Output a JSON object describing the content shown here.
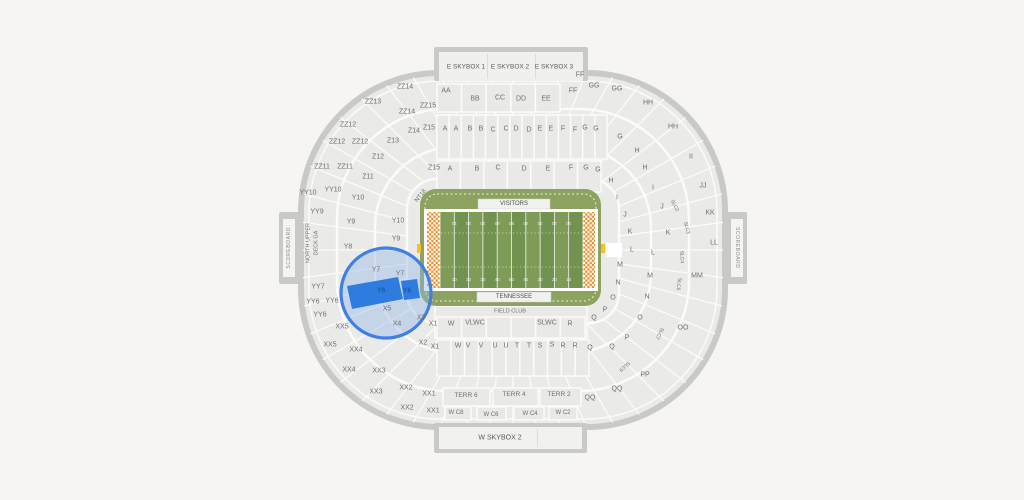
{
  "page": {
    "background": "#f6f5f3"
  },
  "stadium": {
    "scoreboard_left": "SCOREBOARD",
    "scoreboard_right": "SCOREBOARD",
    "skybox_top": [
      "E SKYBOX 1",
      "E SKYBOX 2",
      "E SKYBOX 3"
    ],
    "skybox_bottom": "W SKYBOX 2",
    "field": {
      "visitors_label": "VISITORS",
      "home_label": "TENNESSEE",
      "field_club_label": "FIELD CLUB",
      "corner_label": "NT18",
      "yards": [
        "10",
        "20",
        "30",
        "40",
        "50",
        "40",
        "30",
        "20",
        "10"
      ]
    },
    "selection": {
      "sections": [
        "Y6",
        "Y6"
      ]
    },
    "colors": {
      "selection_fill": "#2e7ce0",
      "selection_ring": "#3f80e2",
      "selection_tint": "#93b5e6",
      "selection_label": "#1c59ad",
      "field_stripe_light": "#7e9c58",
      "field_stripe_dark": "#72924f",
      "field_apron": "#8da25e",
      "endzone_orange": "#ef8a23",
      "bowl_fill": "#eaeae9",
      "ring_stroke": "#c9c9c8"
    },
    "labels": [
      {
        "t": "ZZ14",
        "x": 405,
        "y": 87
      },
      {
        "t": "ZZ13",
        "x": 373,
        "y": 102
      },
      {
        "t": "ZZ14",
        "x": 407,
        "y": 112
      },
      {
        "t": "ZZ15",
        "x": 428,
        "y": 106
      },
      {
        "t": "ZZ12",
        "x": 348,
        "y": 125
      },
      {
        "t": "ZZ12",
        "x": 337,
        "y": 142
      },
      {
        "t": "ZZ12",
        "x": 360,
        "y": 142
      },
      {
        "t": "ZZ11",
        "x": 322,
        "y": 167
      },
      {
        "t": "ZZ11",
        "x": 345,
        "y": 167
      },
      {
        "t": "YY10",
        "x": 308,
        "y": 193
      },
      {
        "t": "YY10",
        "x": 333,
        "y": 190
      },
      {
        "t": "YY9",
        "x": 317,
        "y": 212
      },
      {
        "t": "YY7",
        "x": 318,
        "y": 287
      },
      {
        "t": "YY6",
        "x": 313,
        "y": 302
      },
      {
        "t": "YY6",
        "x": 332,
        "y": 301
      },
      {
        "t": "YY6",
        "x": 320,
        "y": 315
      },
      {
        "t": "XX5",
        "x": 342,
        "y": 327
      },
      {
        "t": "XX5",
        "x": 330,
        "y": 345
      },
      {
        "t": "XX4",
        "x": 356,
        "y": 350
      },
      {
        "t": "XX4",
        "x": 349,
        "y": 370
      },
      {
        "t": "XX3",
        "x": 379,
        "y": 371
      },
      {
        "t": "XX3",
        "x": 376,
        "y": 392
      },
      {
        "t": "XX2",
        "x": 406,
        "y": 388
      },
      {
        "t": "XX2",
        "x": 407,
        "y": 408
      },
      {
        "t": "XX1",
        "x": 429,
        "y": 394
      },
      {
        "t": "XX1",
        "x": 433,
        "y": 411
      },
      {
        "t": "Z15",
        "x": 429,
        "y": 128
      },
      {
        "t": "Z14",
        "x": 414,
        "y": 131
      },
      {
        "t": "Z13",
        "x": 393,
        "y": 141
      },
      {
        "t": "Z12",
        "x": 378,
        "y": 157
      },
      {
        "t": "Z11",
        "x": 368,
        "y": 177
      },
      {
        "t": "Z15",
        "x": 434,
        "y": 168
      },
      {
        "t": "Y10",
        "x": 358,
        "y": 198
      },
      {
        "t": "Y10",
        "x": 398,
        "y": 221
      },
      {
        "t": "Y9",
        "x": 351,
        "y": 222
      },
      {
        "t": "Y9",
        "x": 396,
        "y": 239
      },
      {
        "t": "Y8",
        "x": 348,
        "y": 247
      },
      {
        "t": "Y7",
        "x": 376,
        "y": 270
      },
      {
        "t": "Y7",
        "x": 400,
        "y": 274
      },
      {
        "t": "Y6",
        "x": 381,
        "y": 291,
        "c": "#1c59ad",
        "w": 700,
        "n": "selected-section-label-y6"
      },
      {
        "t": "Y6",
        "x": 407,
        "y": 291,
        "c": "#1c59ad",
        "w": 700,
        "n": "selected-section-label-y6"
      },
      {
        "t": "X5",
        "x": 387,
        "y": 309
      },
      {
        "t": "X4",
        "x": 397,
        "y": 324
      },
      {
        "t": "X3",
        "x": 421,
        "y": 318
      },
      {
        "t": "X2",
        "x": 423,
        "y": 343
      },
      {
        "t": "X1",
        "x": 433,
        "y": 324
      },
      {
        "t": "X1",
        "x": 435,
        "y": 347
      },
      {
        "t": "NORTH UPPER",
        "x": 309,
        "y": 243,
        "r": -90,
        "s": 5.5,
        "n": "north-upper-deck-ga-label"
      },
      {
        "t": "DECK GA",
        "x": 317,
        "y": 243,
        "r": -90,
        "s": 5.5,
        "n": "north-upper-deck-ga-label"
      },
      {
        "t": "NT18",
        "x": 421,
        "y": 196,
        "r": -52,
        "s": 6
      },
      {
        "t": "AA",
        "x": 446,
        "y": 91
      },
      {
        "t": "BB",
        "x": 475,
        "y": 99
      },
      {
        "t": "CC",
        "x": 500,
        "y": 98
      },
      {
        "t": "DD",
        "x": 521,
        "y": 99
      },
      {
        "t": "EE",
        "x": 546,
        "y": 99
      },
      {
        "t": "FF",
        "x": 573,
        "y": 91
      },
      {
        "t": "FF",
        "x": 580,
        "y": 75
      },
      {
        "t": "A",
        "x": 445,
        "y": 129
      },
      {
        "t": "A",
        "x": 456,
        "y": 129
      },
      {
        "t": "B",
        "x": 470,
        "y": 129
      },
      {
        "t": "B",
        "x": 481,
        "y": 129
      },
      {
        "t": "C",
        "x": 493,
        "y": 130
      },
      {
        "t": "C",
        "x": 506,
        "y": 129
      },
      {
        "t": "D",
        "x": 516,
        "y": 129
      },
      {
        "t": "D",
        "x": 529,
        "y": 130
      },
      {
        "t": "E",
        "x": 540,
        "y": 129
      },
      {
        "t": "E",
        "x": 551,
        "y": 129
      },
      {
        "t": "F",
        "x": 563,
        "y": 129
      },
      {
        "t": "F",
        "x": 575,
        "y": 130
      },
      {
        "t": "G",
        "x": 585,
        "y": 128
      },
      {
        "t": "G",
        "x": 596,
        "y": 129
      },
      {
        "t": "A",
        "x": 450,
        "y": 169
      },
      {
        "t": "B",
        "x": 477,
        "y": 169
      },
      {
        "t": "C",
        "x": 498,
        "y": 168
      },
      {
        "t": "D",
        "x": 524,
        "y": 169
      },
      {
        "t": "E",
        "x": 548,
        "y": 169
      },
      {
        "t": "F",
        "x": 571,
        "y": 168
      },
      {
        "t": "G",
        "x": 586,
        "y": 168
      },
      {
        "t": "G",
        "x": 598,
        "y": 170
      },
      {
        "t": "H",
        "x": 611,
        "y": 181
      },
      {
        "t": "GG",
        "x": 594,
        "y": 86
      },
      {
        "t": "GG",
        "x": 617,
        "y": 89
      },
      {
        "t": "HH",
        "x": 648,
        "y": 103
      },
      {
        "t": "HH",
        "x": 673,
        "y": 127
      },
      {
        "t": "II",
        "x": 691,
        "y": 157
      },
      {
        "t": "JJ",
        "x": 703,
        "y": 186
      },
      {
        "t": "KK",
        "x": 710,
        "y": 213
      },
      {
        "t": "LL",
        "x": 714,
        "y": 243
      },
      {
        "t": "MM",
        "x": 697,
        "y": 276
      },
      {
        "t": "OO",
        "x": 683,
        "y": 328
      },
      {
        "t": "PP",
        "x": 645,
        "y": 375
      },
      {
        "t": "QQ",
        "x": 617,
        "y": 389
      },
      {
        "t": "QQ",
        "x": 590,
        "y": 398
      },
      {
        "t": "G",
        "x": 620,
        "y": 137
      },
      {
        "t": "H",
        "x": 637,
        "y": 151
      },
      {
        "t": "H",
        "x": 645,
        "y": 168
      },
      {
        "t": "I",
        "x": 617,
        "y": 198
      },
      {
        "t": "I",
        "x": 653,
        "y": 188
      },
      {
        "t": "J",
        "x": 625,
        "y": 215
      },
      {
        "t": "J",
        "x": 662,
        "y": 207
      },
      {
        "t": "K",
        "x": 630,
        "y": 232
      },
      {
        "t": "K",
        "x": 668,
        "y": 233
      },
      {
        "t": "L",
        "x": 632,
        "y": 250
      },
      {
        "t": "L",
        "x": 653,
        "y": 253
      },
      {
        "t": "M",
        "x": 620,
        "y": 265
      },
      {
        "t": "M",
        "x": 650,
        "y": 276
      },
      {
        "t": "N",
        "x": 618,
        "y": 283
      },
      {
        "t": "N",
        "x": 647,
        "y": 297
      },
      {
        "t": "O",
        "x": 613,
        "y": 298
      },
      {
        "t": "O",
        "x": 640,
        "y": 318
      },
      {
        "t": "P",
        "x": 605,
        "y": 310
      },
      {
        "t": "P",
        "x": 627,
        "y": 338
      },
      {
        "t": "Q",
        "x": 594,
        "y": 318
      },
      {
        "t": "Q",
        "x": 590,
        "y": 348
      },
      {
        "t": "Q",
        "x": 612,
        "y": 347
      },
      {
        "t": "SLC2",
        "x": 674,
        "y": 206,
        "r": 62,
        "s": 5
      },
      {
        "t": "SLC3",
        "x": 686,
        "y": 228,
        "r": 75,
        "s": 5
      },
      {
        "t": "SLC4",
        "x": 681,
        "y": 257,
        "r": 88,
        "s": 5
      },
      {
        "t": "SLC5",
        "x": 678,
        "y": 284,
        "r": 98,
        "s": 5
      },
      {
        "t": "SLC7",
        "x": 659,
        "y": 333,
        "r": 118,
        "s": 5
      },
      {
        "t": "SLC9",
        "x": 624,
        "y": 366,
        "r": 136,
        "s": 5
      },
      {
        "t": "FIELD CLUB",
        "x": 510,
        "y": 312,
        "s": 5.5,
        "i": false,
        "n": "field-club-label"
      },
      {
        "t": "W",
        "x": 451,
        "y": 324
      },
      {
        "t": "VLWC",
        "x": 475,
        "y": 323
      },
      {
        "t": "SLWC",
        "x": 547,
        "y": 323
      },
      {
        "t": "R",
        "x": 570,
        "y": 324
      },
      {
        "t": "W",
        "x": 458,
        "y": 346
      },
      {
        "t": "V",
        "x": 468,
        "y": 346
      },
      {
        "t": "V",
        "x": 481,
        "y": 346
      },
      {
        "t": "U",
        "x": 495,
        "y": 346
      },
      {
        "t": "U",
        "x": 506,
        "y": 346
      },
      {
        "t": "T",
        "x": 517,
        "y": 346
      },
      {
        "t": "T",
        "x": 529,
        "y": 346
      },
      {
        "t": "S",
        "x": 540,
        "y": 346
      },
      {
        "t": "S",
        "x": 552,
        "y": 345
      },
      {
        "t": "R",
        "x": 563,
        "y": 346
      },
      {
        "t": "R",
        "x": 575,
        "y": 346
      },
      {
        "t": "TERR 6",
        "x": 466,
        "y": 396,
        "s": 6.5
      },
      {
        "t": "TERR 4",
        "x": 514,
        "y": 395,
        "s": 6.5
      },
      {
        "t": "TERR 2",
        "x": 559,
        "y": 395,
        "s": 6.5
      },
      {
        "t": "W C8",
        "x": 456,
        "y": 413,
        "s": 6
      },
      {
        "t": "W C6",
        "x": 491,
        "y": 415,
        "s": 6
      },
      {
        "t": "W C4",
        "x": 530,
        "y": 414,
        "s": 6
      },
      {
        "t": "W C2",
        "x": 563,
        "y": 413,
        "s": 6
      },
      {
        "t": "VISITORS",
        "x": 514,
        "y": 204,
        "s": 6,
        "c": "#4c4c4c",
        "i": false,
        "n": "visitors-endzone-label"
      },
      {
        "t": "TENNESSEE",
        "x": 514,
        "y": 297,
        "s": 6,
        "c": "#4c4c4c",
        "i": false,
        "n": "tennessee-endzone-label"
      }
    ]
  }
}
